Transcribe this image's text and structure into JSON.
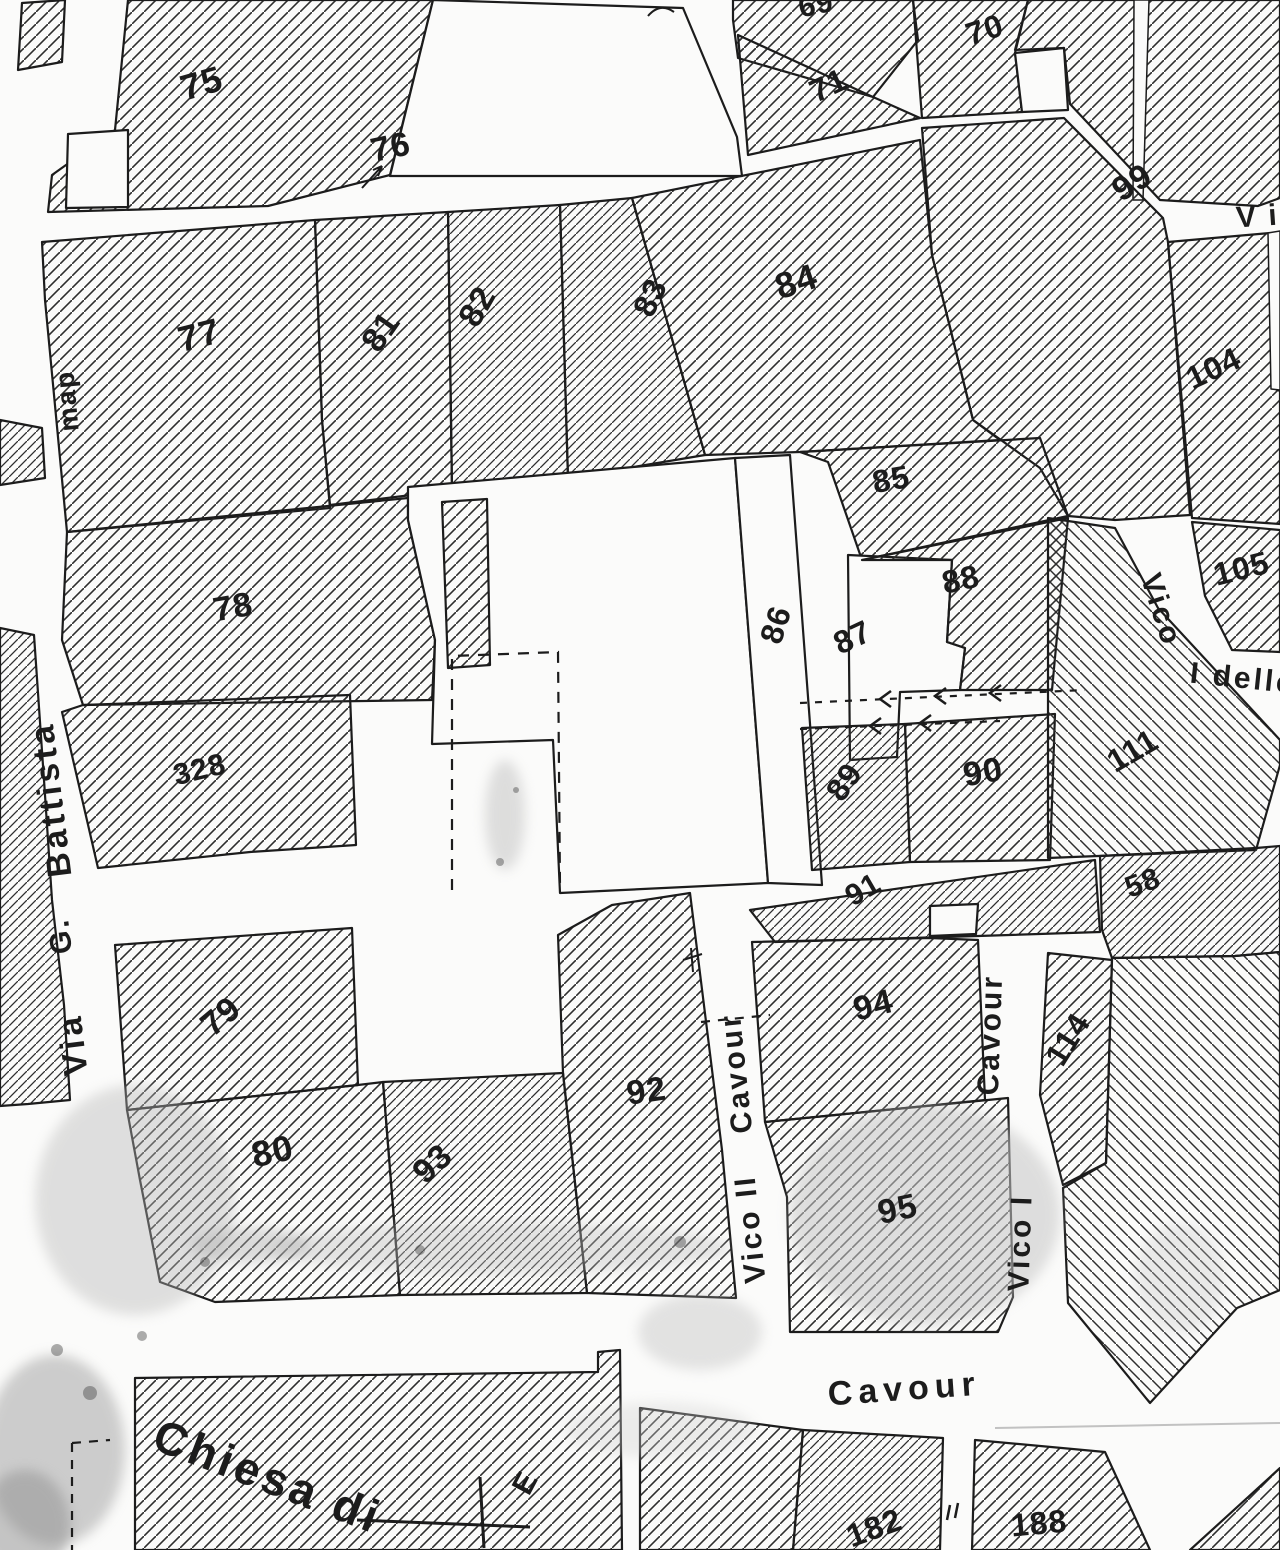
{
  "map": {
    "colors": {
      "ink": "#1c1c1c",
      "paper": "#fbfbfa"
    },
    "parcel_numbers": [
      "69",
      "70",
      "71",
      "75",
      "76",
      "77",
      "78",
      "79",
      "80",
      "81",
      "82",
      "83",
      "84",
      "85",
      "86",
      "87",
      "88",
      "89",
      "90",
      "91",
      "92",
      "93",
      "94",
      "95",
      "99",
      "104",
      "105",
      "111",
      "114",
      "58",
      "328",
      "182",
      "188"
    ],
    "street_labels": [
      {
        "id": "via-g-battista",
        "words": [
          "Via",
          "G.",
          "Battista"
        ]
      },
      {
        "id": "vico-ii-cavour",
        "words": [
          "Vico II",
          "Cavour"
        ]
      },
      {
        "id": "vico-i-cavour",
        "words": [
          "Vico I",
          "Cavour"
        ]
      },
      {
        "id": "cavour",
        "words": [
          "Cavour"
        ]
      },
      {
        "id": "vico-i-delle",
        "words": [
          "Vico",
          "I delle"
        ]
      },
      {
        "id": "via-cut-top-right",
        "words": [
          "V i"
        ]
      },
      {
        "id": "partial-label-left-margin",
        "words": [
          "map"
        ]
      }
    ],
    "poi_labels": [
      {
        "id": "church",
        "text": "Chiesa di"
      },
      {
        "id": "benchmark",
        "text": "E"
      }
    ]
  }
}
